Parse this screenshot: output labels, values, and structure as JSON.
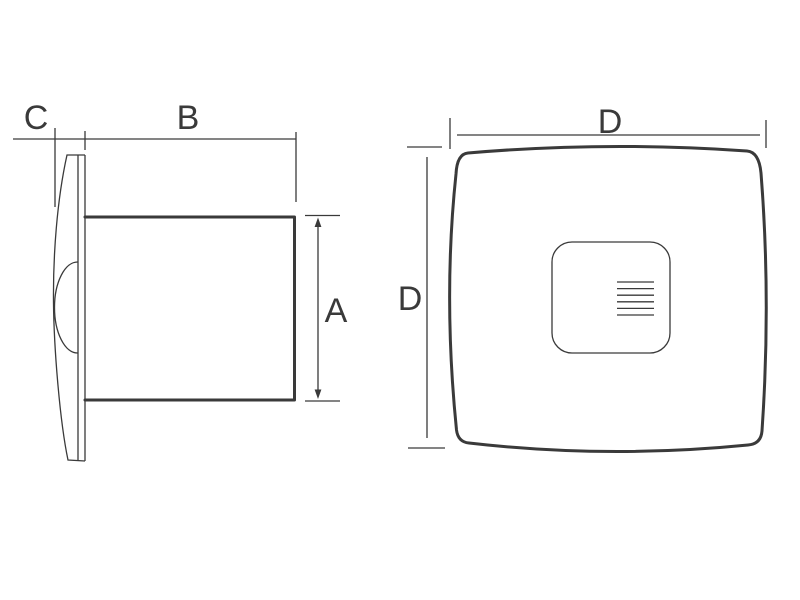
{
  "diagram": {
    "labels": {
      "c": "C",
      "b": "B",
      "a": "A",
      "d_top": "D",
      "d_left": "D"
    },
    "colors": {
      "line": "#3a3a3a",
      "text": "#3a3a3a",
      "background": "#ffffff"
    }
  }
}
